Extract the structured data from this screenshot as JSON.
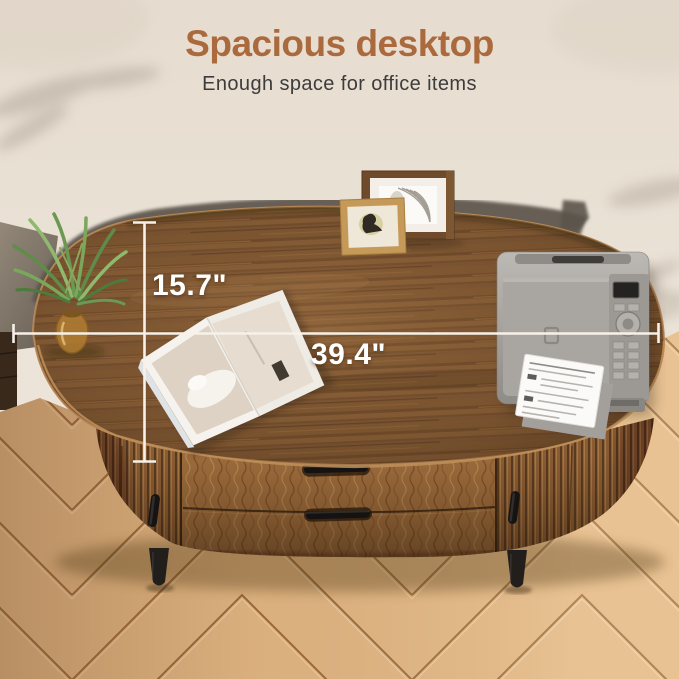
{
  "header": {
    "title": "Spacious desktop",
    "subtitle": "Enough space for office items"
  },
  "annotations": {
    "depth_label": "15.7\"",
    "width_label": "39.4\"",
    "line_color": "#f7f1e8",
    "text_color": "#ffffff"
  },
  "colors": {
    "title": "#aa6a3e",
    "subtitle": "#3c3c3c",
    "wall": "#ebe3d8",
    "desk_top_wood": "#7b5330",
    "desk_base_wood": "#996a3b",
    "hardware_black": "#1a1816",
    "floor_plank": "#e3b886",
    "floor_seam": "#9c6a3a"
  },
  "scene": {
    "description": "Top-down view of an oval walnut desk with fluted base, drawers and black handles standing on a chevron parquet floor against a beige wall",
    "objects": [
      {
        "name": "potted-plant",
        "description": "green palm plant in amber glass vase on left desk edge"
      },
      {
        "name": "picture-frame-large",
        "description": "dark wood frame, white mat, abstract curved-line art"
      },
      {
        "name": "picture-frame-small",
        "description": "gold wood frame, cream mat, small portrait"
      },
      {
        "name": "open-magazine",
        "description": "open interior-design magazine on desktop"
      },
      {
        "name": "printer",
        "description": "gray printer with control panel printing a page"
      }
    ]
  }
}
